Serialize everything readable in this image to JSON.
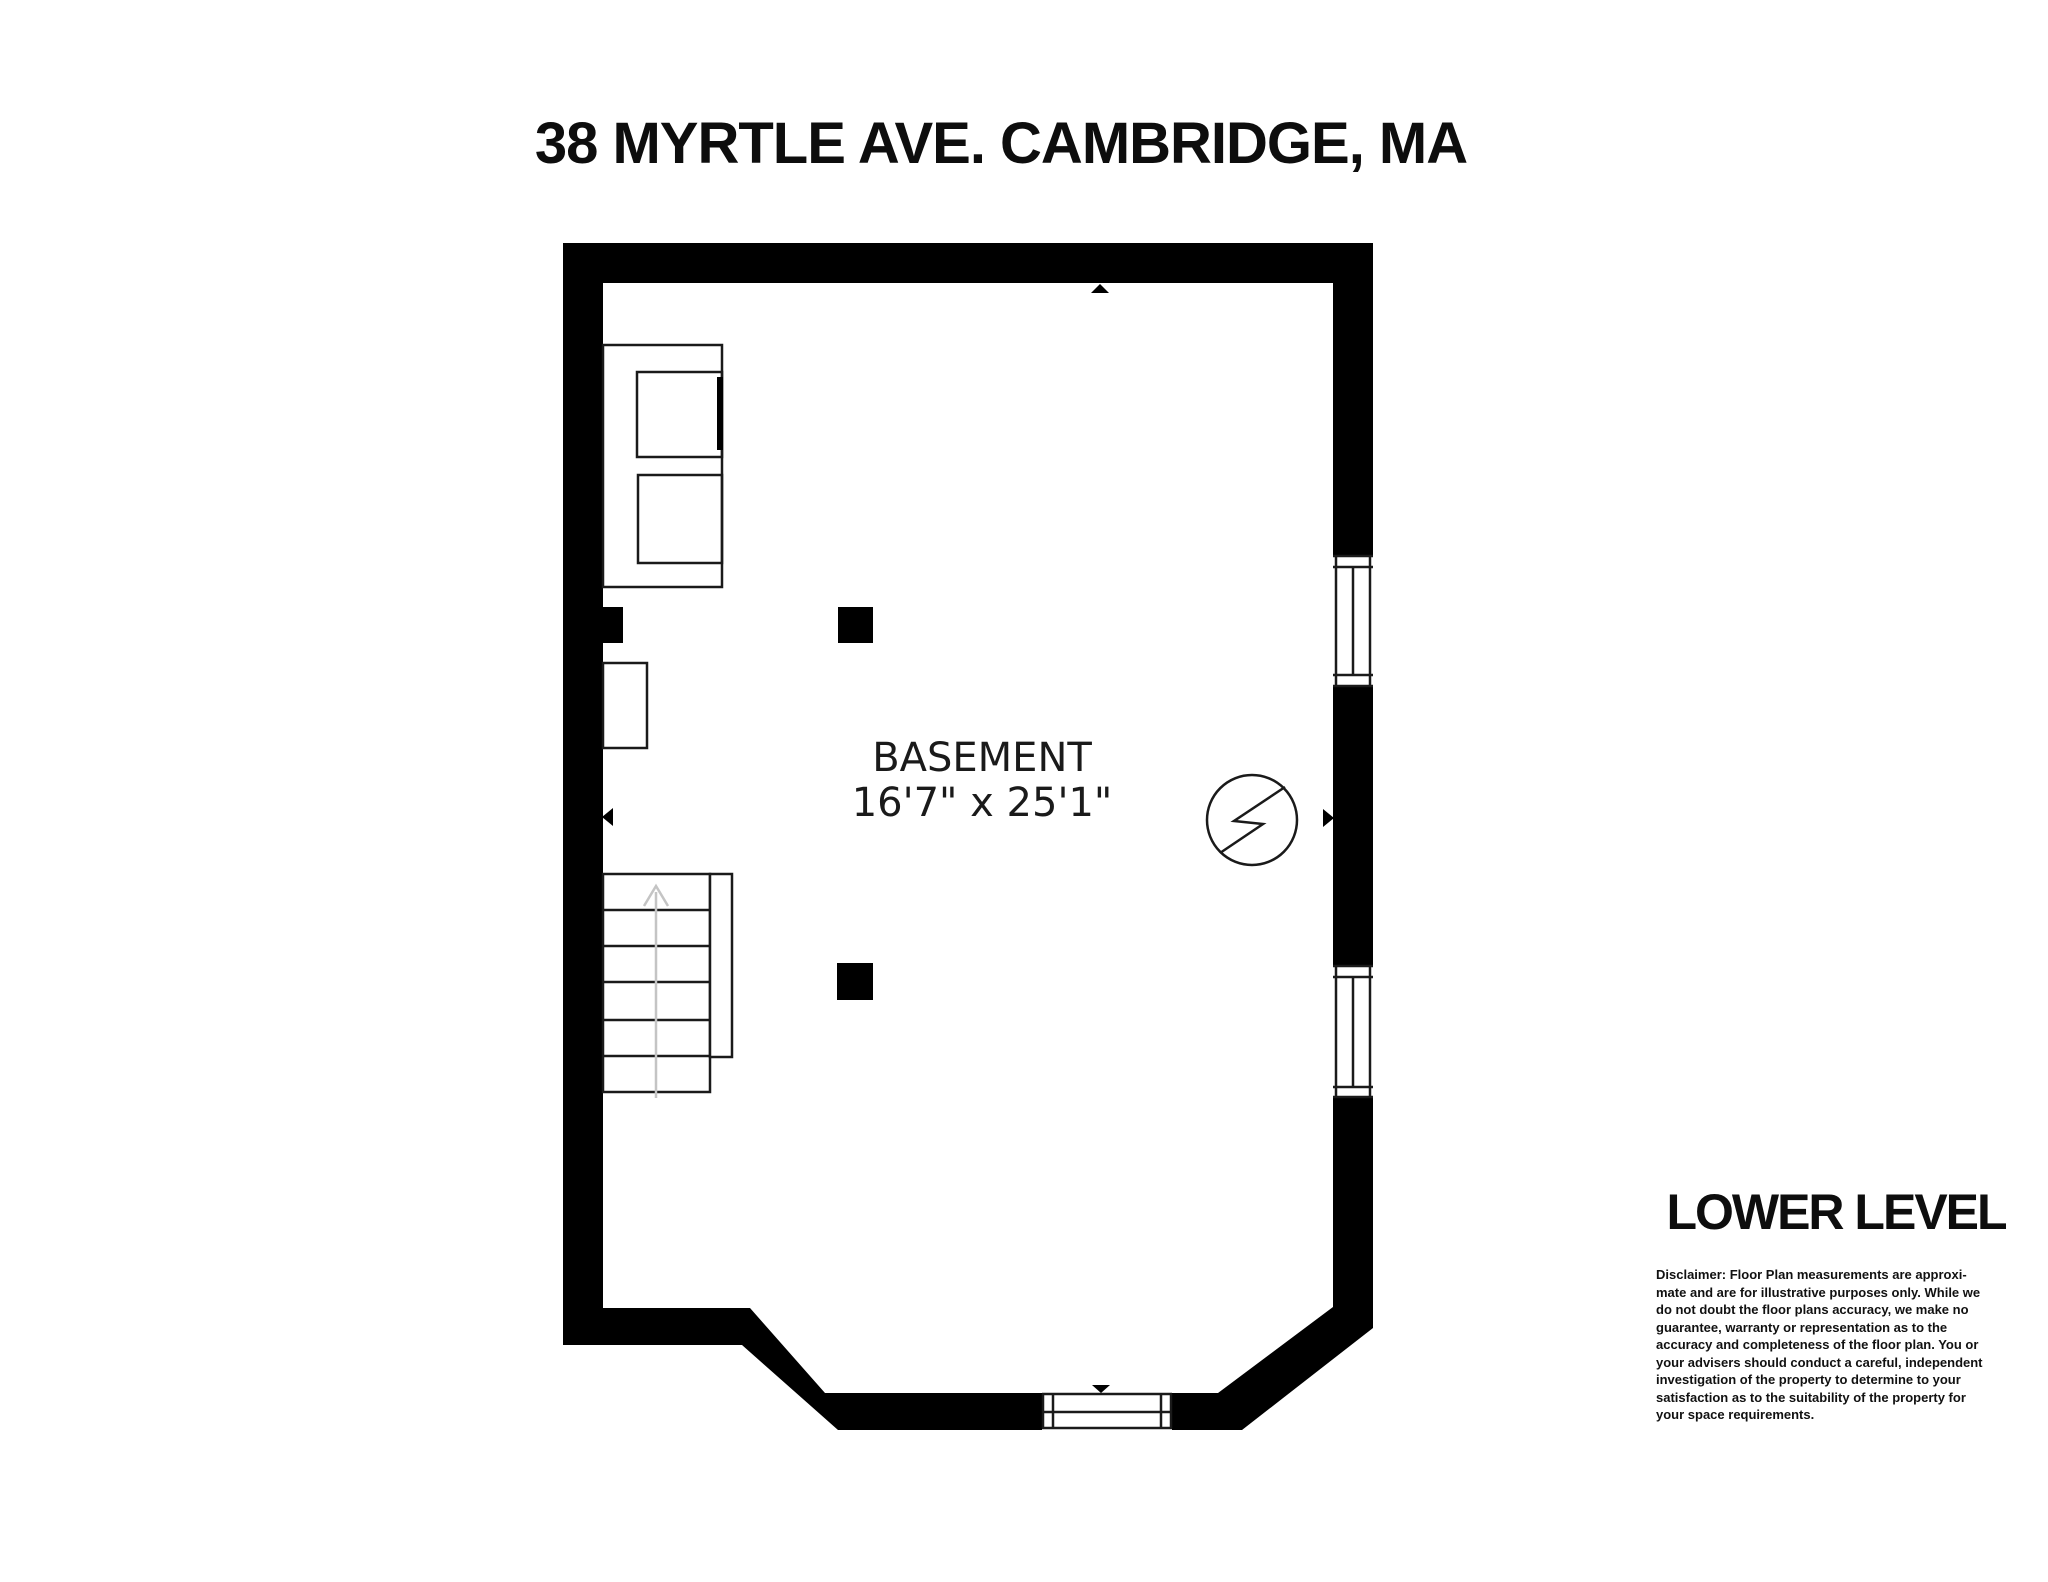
{
  "title": "38 MYRTLE AVE. CAMBRIDGE, MA",
  "room": {
    "name": "BASEMENT",
    "dimensions": "16'7\" x 25'1\""
  },
  "level_label": "LOWER LEVEL",
  "disclaimer": "Disclaimer: Floor Plan measurements are approxi-\nmate and are for illustrative purposes only. While we\ndo not doubt the floor plans accuracy, we make no\nguarantee, warranty or representation as to the\naccuracy and completeness of the floor plan. You or\nyour advisers should conduct a careful, independent\ninvestigation of the property to determine to your\nsatisfaction as to the suitability of the property for\nyour space requirements.",
  "symbols": {
    "electrical_panel": "circle-lightning-bolt",
    "stair_direction": "up-arrow",
    "dimension_markers": [
      "up-arrow",
      "down-arrow",
      "left-arrow",
      "right-arrow"
    ],
    "structural_posts": 2,
    "windows": [
      "right-wall-upper",
      "right-wall-lower",
      "bay-bottom"
    ],
    "appliances": [
      "washer",
      "dryer"
    ]
  },
  "colors": {
    "wall": "#000000",
    "floor": "#ffffff",
    "line": "#1a1a1a",
    "stair_arrow": "#c4c4c4",
    "text": "#0d0d0d"
  }
}
